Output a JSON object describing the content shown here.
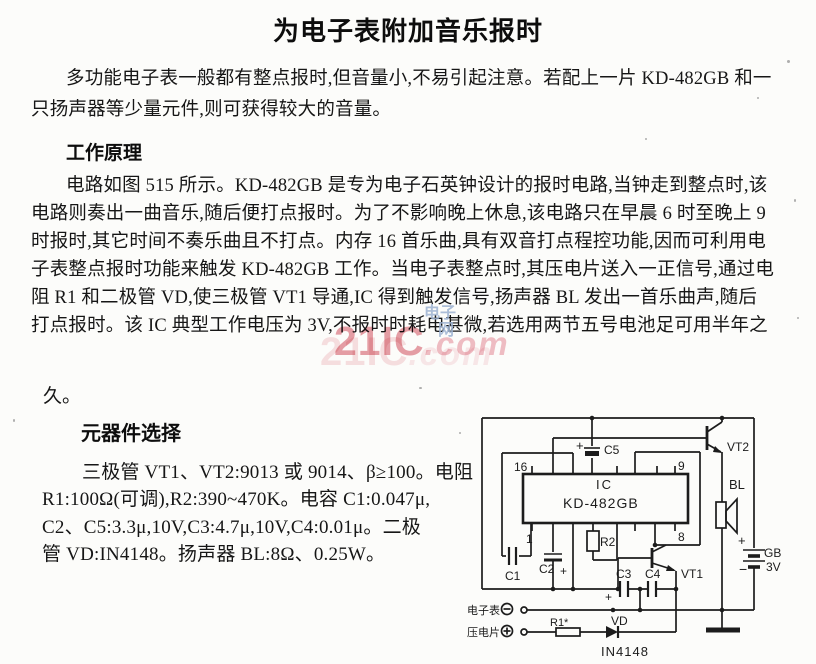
{
  "page": {
    "title": "为电子表附加音乐报时"
  },
  "paragraphs": {
    "intro": {
      "lines": [
        "多功能电子表一般都有整点报时,但音量小,不易引起注意。若配上一片 KD-482GB 和一",
        "只扬声器等少量元件,则可获得较大的音量。"
      ]
    },
    "principle_heading": "工作原理",
    "principle": {
      "lines": [
        "电路如图 515 所示。KD-482GB 是专为电子石英钟设计的报时电路,当钟走到整点时,该",
        "电路则奏出一曲音乐,随后便打点报时。为了不影响晚上休息,该电路只在早晨 6 时至晚上 9",
        "时报时,其它时间不奏乐曲且不打点。内存 16 首乐曲,具有双音打点程控功能,因而可利用电",
        "子表整点报时功能来触发 KD-482GB 工作。当电子表整点时,其压电片送入一正信号,通过电",
        "阻 R1 和二极管 VD,使三极管 VT1 导通,IC 得到触发信号,扬声器 BL 发出一首乐曲声,随后",
        "打点报时。该 IC 典型工作电压为 3V,不报时时耗电甚微,若选用两节五号电池足可用半年之"
      ]
    },
    "principle_tail": "久。",
    "components_heading": "元器件选择",
    "components": {
      "lines": [
        "三极管 VT1、VT2:9013 或 9014、β≥100。电阻",
        "R1:100Ω(可调),R2:390~470K。电容 C1:0.047μ,",
        "C2、C5:3.3μ,10V,C3:4.7μ,10V,C4:0.01μ。二极",
        "管 VD:IN4148。扬声器 BL:8Ω、0.25W。"
      ]
    }
  },
  "watermark": {
    "brand": "21IC",
    "suffix": ".com",
    "overlay_line1": "电子",
    "overlay_line2": "网",
    "pink": "#e28792",
    "blue": "#9db3d2"
  },
  "figure": {
    "ic_label": "IC",
    "ic_part": "KD-482GB",
    "pins": {
      "p16": "16",
      "p9": "9",
      "p1": "1",
      "p8": "8"
    },
    "labels": {
      "c1": "C1",
      "c2": "C2",
      "c3": "C3",
      "c4": "C4",
      "c5": "C5",
      "r1": "R1*",
      "r2": "R2",
      "vd": "VD",
      "vd_part": "IN4148",
      "vt1": "VT1",
      "vt2": "VT2",
      "bl": "BL",
      "gb": "GB",
      "gb_volts": "3V",
      "plus": "+",
      "minus": "−"
    },
    "terminals": {
      "watch": "电子表",
      "piezo": "压电片"
    }
  }
}
